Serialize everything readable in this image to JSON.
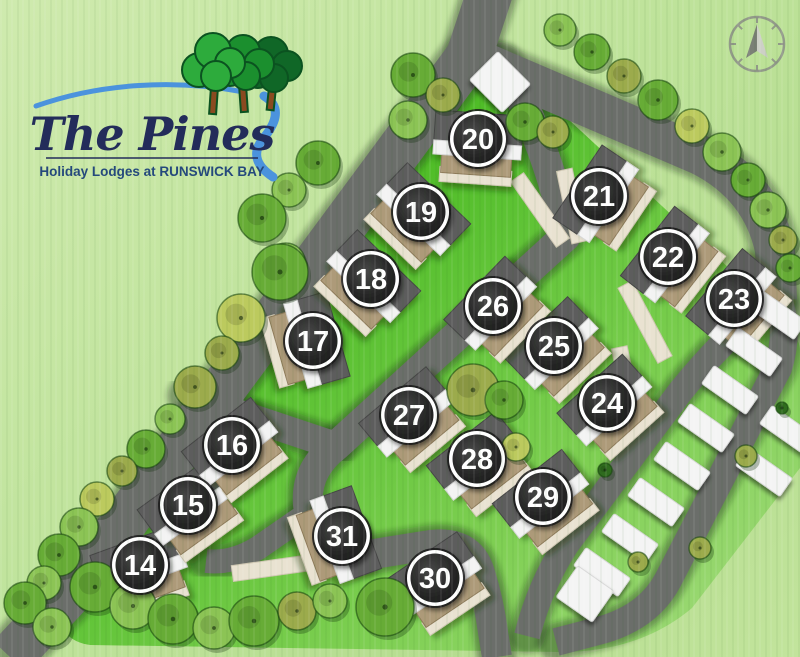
{
  "meta": {
    "title": "The Pines holiday lodge park site plan"
  },
  "logo": {
    "name_script": "The Pines",
    "tagline": "Holiday Lodges at RUNSWICK BAY",
    "colors": {
      "script_text": "#232c5a",
      "tagline_text": "#25497c",
      "swoosh_blue": "#4b93dd",
      "tree_front": "#2dab3c",
      "tree_mid": "#1b8f2e",
      "tree_back": "#106727",
      "tree_outline": "#0b5220",
      "trunk": "#8a4a20"
    }
  },
  "compass": {
    "x": 757,
    "y": 44,
    "r": 27,
    "ring": "#8d9287",
    "arrow_dark": "#7b8076",
    "arrow_light": "#cdd0c6"
  },
  "colors": {
    "site_green_top": "#62c937",
    "site_green_mid": "#4fbd27",
    "site_green_low": "#7ecf52",
    "site_green_fade": "#a6dc80",
    "road": "#6b6e6a",
    "road_shadow": "rgba(30,35,28,0.38)",
    "cream": "#e9e2d1",
    "cream_edge": "#cfc7b2",
    "deck_tan": "#ad9a79",
    "deck_edge": "#8d7a58",
    "roof_dark": "#5d5d5d",
    "roof_edge": "#454545",
    "roof_white": "#f3f3f3",
    "caravan_white": "#f4f4f4",
    "badge_ring": "#ffffff",
    "badge_face_outer": "#484848",
    "badge_face_inner": "#161616",
    "badge_number": "#ffffff"
  },
  "site_outline": "M 472,30 L 772,308 Q 800,335 800,350 L 800,468 L 692,608 Q 640,652 560,652 L 90,645 Q 55,640 58,600 Z",
  "roads": [
    {
      "name": "entrance-and-west-boundary-road",
      "path": "M 494,-20 L 469,56 L 80,582 L 10,657",
      "w": 46
    },
    {
      "name": "north-east-road",
      "path": "M 469,56 L 700,155 Q 762,186 775,250 L 777,300",
      "w": 40
    },
    {
      "name": "central-spine-road",
      "path": "M 502,62 Q 550,150 566,236 L 336,446 Q 305,470 308,505 L 310,518 Q 313,550 355,557 L 430,545 Q 470,540 480,573 Q 489,602 493,632 L 497,657",
      "w": 30
    },
    {
      "name": "east-caravan-road",
      "path": "M 777,296 Q 790,330 778,368 L 668,580 Q 648,618 598,631 L 556,642",
      "w": 28
    },
    {
      "name": "inner-caravan-road",
      "path": "M 772,298 Q 722,340 680,392 L 566,545 Q 540,585 527,636",
      "w": 26
    },
    {
      "name": "west-junction-road",
      "path": "M 186,396 L 336,446",
      "w": 28
    },
    {
      "name": "south-west-stub-road",
      "path": "M 310,512 L 258,548 Q 232,564 206,561",
      "w": 24
    }
  ],
  "parking_strips": [
    {
      "x": 572,
      "y": 206,
      "len": 74,
      "rot": 78
    },
    {
      "x": 645,
      "y": 322,
      "len": 85,
      "rot": 62
    },
    {
      "x": 627,
      "y": 384,
      "len": 75,
      "rot": 78
    },
    {
      "x": 540,
      "y": 210,
      "len": 80,
      "rot": 55
    },
    {
      "x": 272,
      "y": 568,
      "len": 80,
      "rot": -8
    }
  ],
  "lodges": [
    {
      "number": "14",
      "x": 140,
      "y": 565,
      "rot": -20
    },
    {
      "number": "15",
      "x": 188,
      "y": 505,
      "rot": -36
    },
    {
      "number": "16",
      "x": 232,
      "y": 445,
      "rot": -38
    },
    {
      "number": "17",
      "x": 313,
      "y": 341,
      "rot": 74
    },
    {
      "number": "18",
      "x": 371,
      "y": 279,
      "rot": 44
    },
    {
      "number": "19",
      "x": 421,
      "y": 212,
      "rot": 44
    },
    {
      "number": "20",
      "x": 478,
      "y": 139,
      "rot": 4
    },
    {
      "number": "21",
      "x": 599,
      "y": 196,
      "rot": -56
    },
    {
      "number": "22",
      "x": 668,
      "y": 257,
      "rot": -52
    },
    {
      "number": "23",
      "x": 734,
      "y": 299,
      "rot": -50
    },
    {
      "number": "24",
      "x": 607,
      "y": 403,
      "rot": -42
    },
    {
      "number": "25",
      "x": 554,
      "y": 346,
      "rot": -44
    },
    {
      "number": "26",
      "x": 493,
      "y": 306,
      "rot": -46
    },
    {
      "number": "27",
      "x": 409,
      "y": 415,
      "rot": -40
    },
    {
      "number": "28",
      "x": 477,
      "y": 459,
      "rot": -38
    },
    {
      "number": "29",
      "x": 543,
      "y": 497,
      "rot": -38
    },
    {
      "number": "30",
      "x": 435,
      "y": 578,
      "rot": -34
    },
    {
      "number": "31",
      "x": 342,
      "y": 536,
      "rot": 70
    }
  ],
  "tree_palette": {
    "l": "#8cc455",
    "m": "#67ac36",
    "d": "#4f9129",
    "y": "#bcca5e",
    "o": "#9cab4c",
    "k": "#2f6b1e"
  },
  "trees": [
    [
      413,
      75,
      22,
      "m"
    ],
    [
      443,
      95,
      17,
      "o"
    ],
    [
      408,
      120,
      19,
      "l"
    ],
    [
      318,
      163,
      22,
      "m"
    ],
    [
      289,
      190,
      17,
      "l"
    ],
    [
      262,
      218,
      24,
      "m"
    ],
    [
      286,
      262,
      19,
      "l"
    ],
    [
      280,
      272,
      28,
      "m"
    ],
    [
      241,
      318,
      24,
      "y"
    ],
    [
      222,
      353,
      17,
      "o"
    ],
    [
      195,
      387,
      21,
      "o"
    ],
    [
      170,
      419,
      15,
      "l"
    ],
    [
      146,
      449,
      19,
      "m"
    ],
    [
      122,
      471,
      15,
      "o"
    ],
    [
      97,
      499,
      17,
      "y"
    ],
    [
      79,
      527,
      19,
      "l"
    ],
    [
      59,
      555,
      21,
      "m"
    ],
    [
      44,
      583,
      17,
      "l"
    ],
    [
      95,
      587,
      25,
      "m"
    ],
    [
      133,
      606,
      23,
      "l"
    ],
    [
      173,
      619,
      25,
      "m"
    ],
    [
      214,
      628,
      21,
      "l"
    ],
    [
      254,
      621,
      25,
      "m"
    ],
    [
      297,
      611,
      19,
      "o"
    ],
    [
      330,
      601,
      17,
      "l"
    ],
    [
      385,
      607,
      29,
      "m"
    ],
    [
      25,
      603,
      21,
      "m"
    ],
    [
      52,
      627,
      19,
      "l"
    ],
    [
      560,
      30,
      16,
      "l"
    ],
    [
      592,
      52,
      18,
      "m"
    ],
    [
      624,
      76,
      17,
      "o"
    ],
    [
      658,
      100,
      20,
      "m"
    ],
    [
      692,
      126,
      17,
      "y"
    ],
    [
      722,
      152,
      19,
      "l"
    ],
    [
      748,
      180,
      17,
      "m"
    ],
    [
      768,
      210,
      18,
      "l"
    ],
    [
      783,
      240,
      14,
      "o"
    ],
    [
      790,
      268,
      14,
      "m"
    ],
    [
      525,
      122,
      19,
      "m"
    ],
    [
      553,
      132,
      16,
      "o"
    ],
    [
      473,
      390,
      26,
      "o"
    ],
    [
      504,
      400,
      19,
      "m"
    ],
    [
      516,
      447,
      14,
      "y"
    ],
    [
      746,
      456,
      11,
      "o"
    ],
    [
      700,
      548,
      11,
      "o"
    ],
    [
      638,
      562,
      10,
      "o"
    ],
    [
      782,
      408,
      6,
      "k"
    ],
    [
      605,
      470,
      7,
      "k"
    ]
  ],
  "caravans": [
    {
      "x": 778,
      "y": 315,
      "rot": 35
    },
    {
      "x": 754,
      "y": 352,
      "rot": 35
    },
    {
      "x": 730,
      "y": 390,
      "rot": 35
    },
    {
      "x": 706,
      "y": 428,
      "rot": 35
    },
    {
      "x": 682,
      "y": 466,
      "rot": 35
    },
    {
      "x": 656,
      "y": 502,
      "rot": 35
    },
    {
      "x": 630,
      "y": 538,
      "rot": 35
    },
    {
      "x": 602,
      "y": 572,
      "rot": 35
    },
    {
      "x": 788,
      "y": 430,
      "rot": 35
    },
    {
      "x": 764,
      "y": 472,
      "rot": 35
    },
    {
      "x": 585,
      "y": 594,
      "rot": 35,
      "w": 44,
      "h": 38
    },
    {
      "x": 500,
      "y": 82,
      "rot": 45,
      "w": 46,
      "h": 40
    }
  ]
}
